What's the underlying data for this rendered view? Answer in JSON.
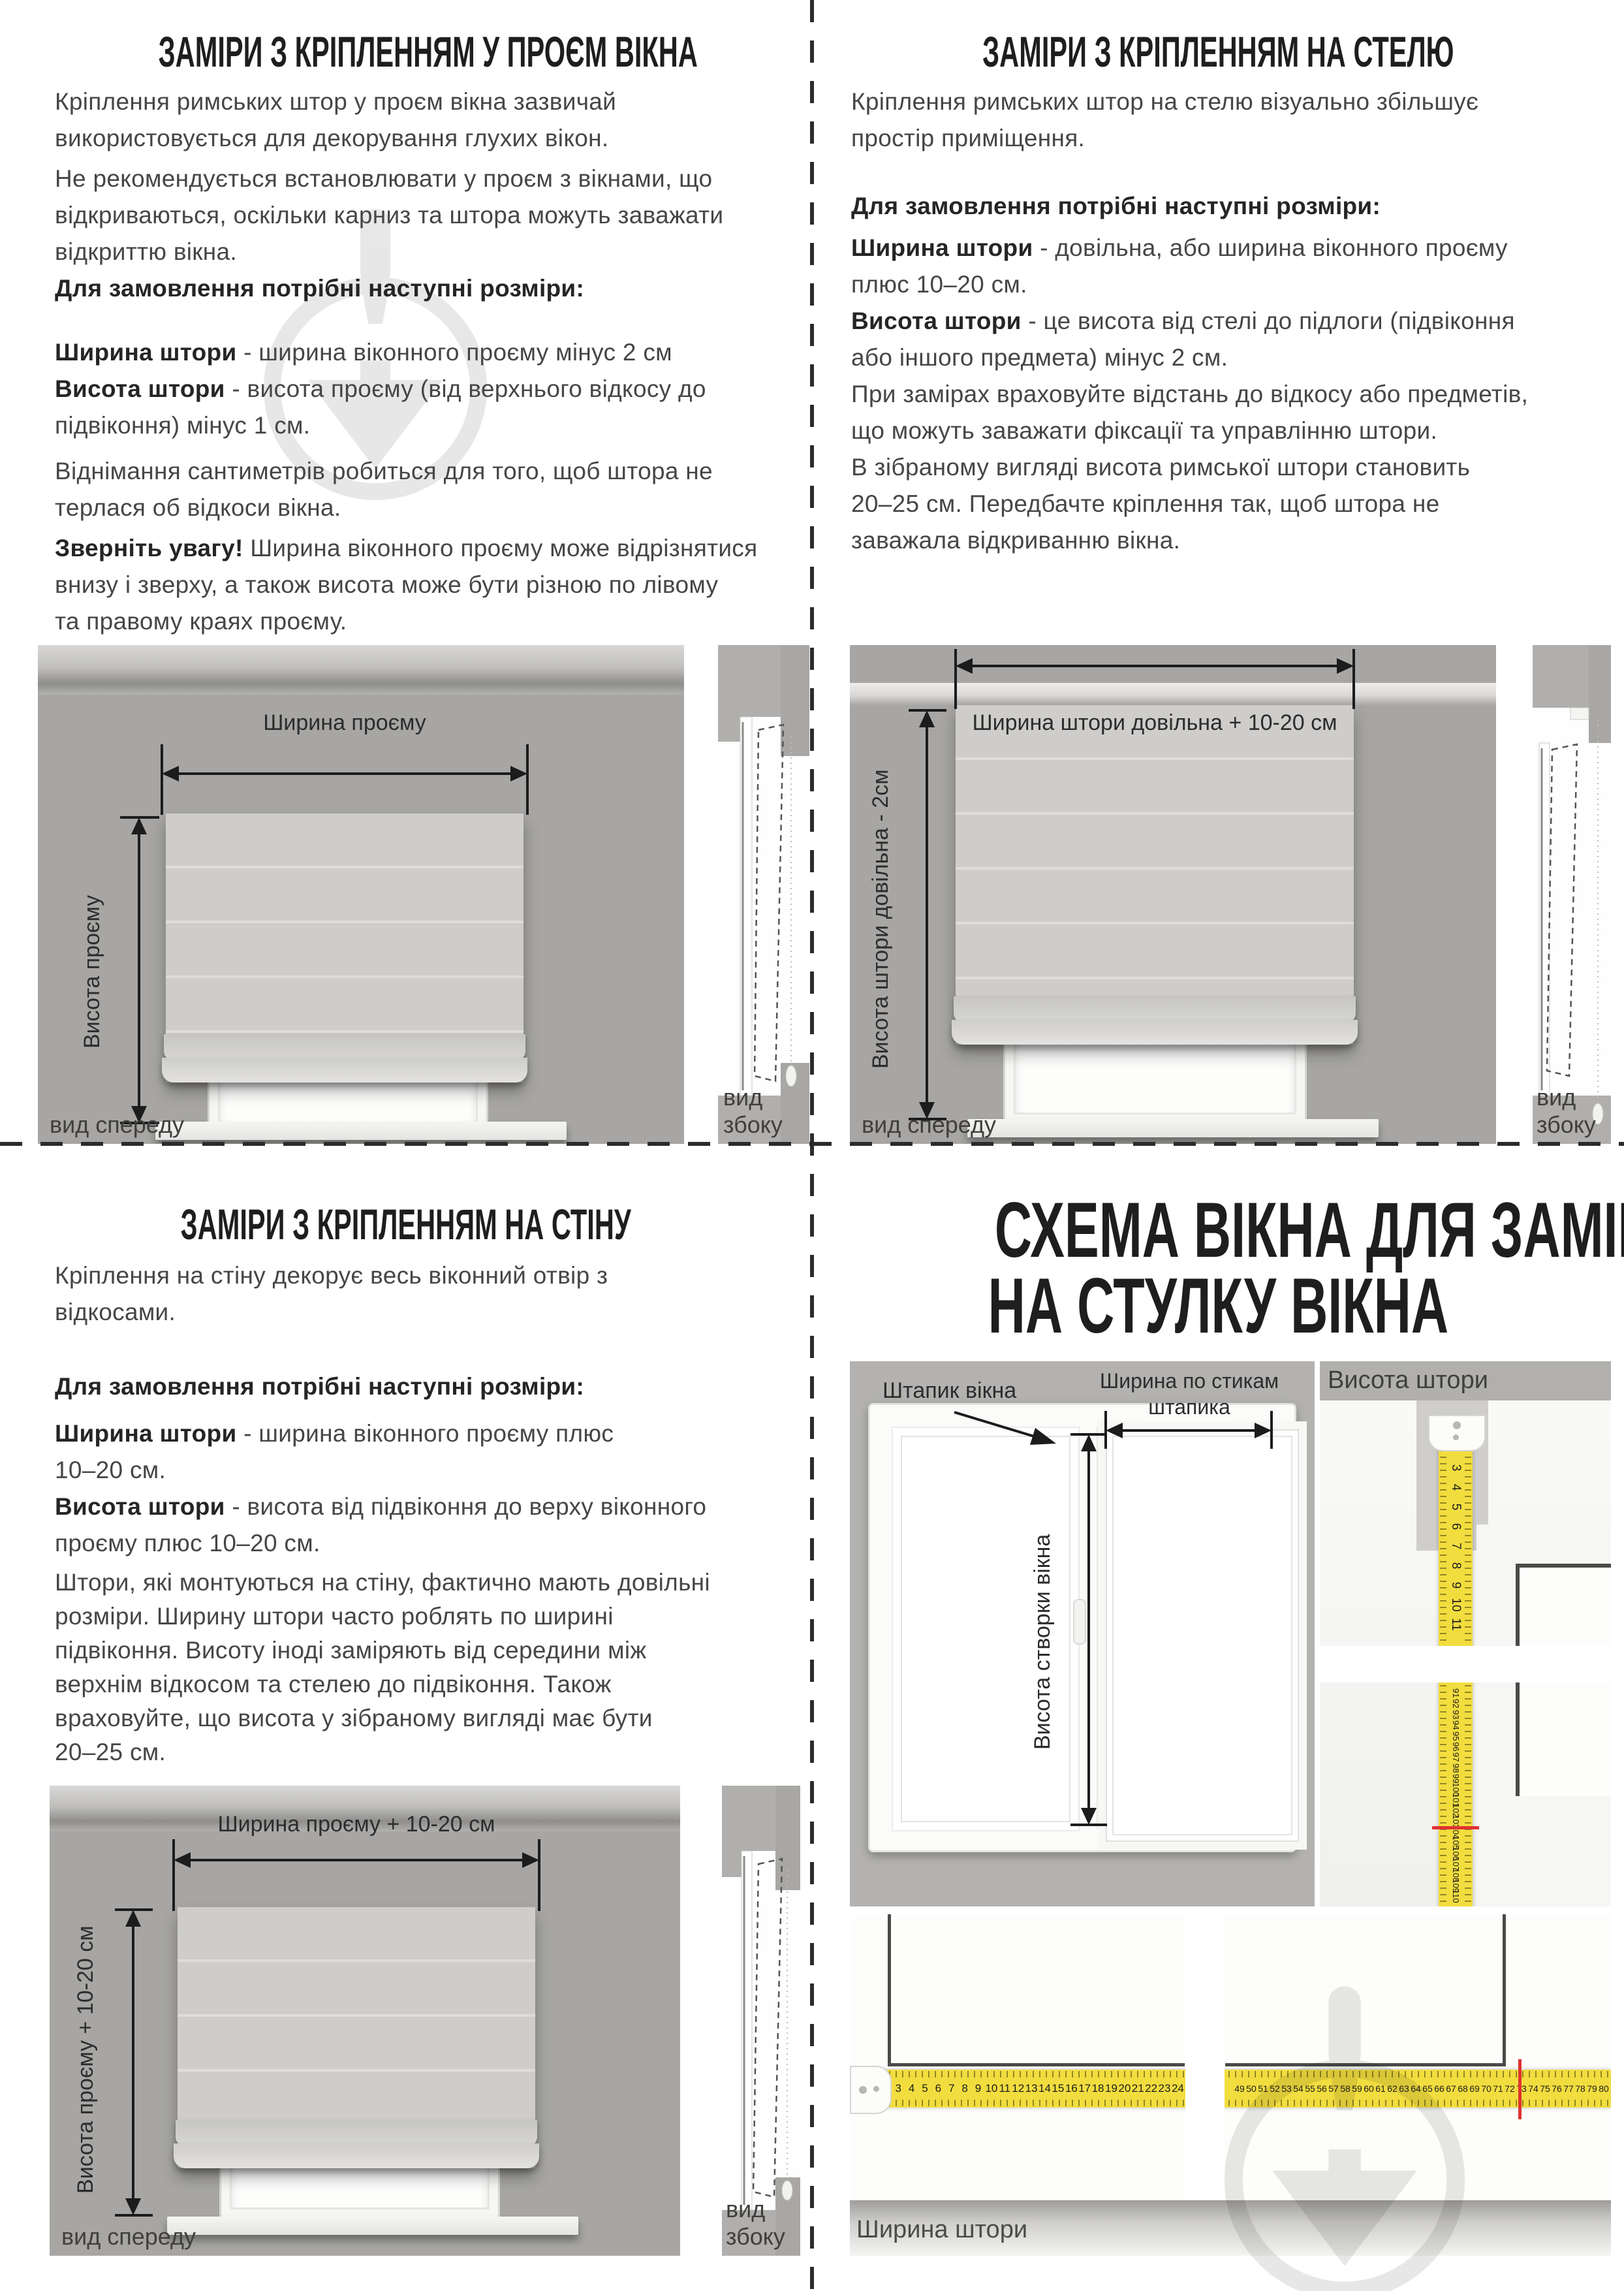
{
  "divider_color": "#2b2b2b",
  "opening": {
    "title": "ЗАМІРИ З КРІПЛЕННЯМ У ПРОЄМ ВІКНА",
    "p1": [
      "Кріплення римських штор у проєм вікна зазвичай",
      "використовується для декорування глухих вікон."
    ],
    "p2": [
      "Не рекомендується встановлювати у проєм з вікнами, що",
      "відкриваються, оскільки карниз та штора можуть заважати",
      "відкриттю вікна."
    ],
    "order_heading": "Для замовлення потрібні наступні розміри:",
    "sizes": [
      {
        "b": "Ширина штори",
        "t": " - ширина віконного проєму мінус 2 см"
      },
      {
        "b": "Висота штори",
        "t": " - висота проєму (від верхнього відкосу до"
      },
      {
        "t": "підвіконня) мінус 1 см."
      }
    ],
    "p3": [
      "Віднімання сантиметрів робиться для того, щоб штора не",
      "терлася об відкоси вікна."
    ],
    "note": [
      {
        "b": "Зверніть увагу!",
        "t": " Ширина віконного проєму може відрізнятися"
      },
      {
        "t": "внизу і зверху, а також висота може бути різною по лівому"
      },
      {
        "t": "та правому краях проєму."
      }
    ],
    "diagram": {
      "width_label": "Ширина проєму",
      "height_label": "Висота проєму",
      "front_view": "вид спереду",
      "side_view": "вид збоку"
    }
  },
  "ceiling": {
    "title": "ЗАМІРИ З КРІПЛЕННЯМ НА СТЕЛЮ",
    "p1": [
      "Кріплення римських штор на стелю візуально збільшує",
      "простір приміщення."
    ],
    "order_heading": "Для замовлення потрібні наступні розміри:",
    "sizes": [
      {
        "b": "Ширина штори",
        "t": " - довільна, або ширина віконного проєму"
      },
      {
        "t": "плюс 10–20 см."
      },
      {
        "b": "Висота штори",
        "t": " - це висота від стелі до підлоги (підвіконня"
      },
      {
        "t": "або іншого предмета) мінус 2 см."
      }
    ],
    "p2": [
      "При замірах враховуйте відстань до відкосу або предметів,",
      "що можуть заважати фіксації та управлінню штори.",
      "В зібраному вигляді висота римської штори становить",
      "20–25 см. Передбачте кріплення так, щоб штора не",
      "заважала відкриванню вікна."
    ],
    "diagram": {
      "width_label": "Ширина штори довільна + 10-20 см",
      "height_label": "Висота штори довільна - 2см",
      "front_view": "вид спереду",
      "side_view": "вид збоку"
    }
  },
  "wall": {
    "title": "ЗАМІРИ З КРІПЛЕННЯМ НА СТІНУ",
    "p1": [
      "Кріплення на стіну декорує весь віконний отвір з",
      "відкосами."
    ],
    "order_heading": "Для замовлення потрібні наступні розміри:",
    "sizes": [
      {
        "b": "Ширина штори",
        "t": " - ширина віконного проєму плюс"
      },
      {
        "t": "10–20 см."
      },
      {
        "b": "Висота штори",
        "t": " - висота від підвіконня до верху віконного"
      },
      {
        "t": "проєму плюс 10–20 см."
      }
    ],
    "p2": [
      "Штори, які монтуються на стіну, фактично мають довільні",
      "розміри. Ширину штори часто роблять по ширині",
      "підвіконня. Висоту іноді заміряють від середини між",
      "верхнім відкосом та стелею до підвіконня. Також",
      "враховуйте, що висота у зібраному вигляді має бути",
      "20–25 см."
    ],
    "diagram": {
      "width_label": "Ширина проєму + 10-20 см",
      "height_label": "Висота проєму + 10-20 см",
      "front_view": "вид спереду",
      "side_view": "вид збоку"
    }
  },
  "sash": {
    "title_line1": "СХЕМА ВІКНА ДЛЯ ЗАМІРІВ",
    "title_line2": "НА СТУЛКУ ВІКНА",
    "bead_label": "Штапик вікна",
    "bead_width_label_line1": "Ширина по стикам",
    "bead_width_label_line2": "штапика",
    "sash_height_label": "Висота створки вікна",
    "curtain_height_label": "Висота штори",
    "curtain_width_label": "Ширина штори",
    "tape": {
      "color": "#f2dd3f",
      "red_mark_color": "#e03232",
      "vertical_top_numbers": [
        3,
        4,
        5,
        6,
        7,
        8,
        9,
        10,
        11
      ],
      "vertical_bottom_numbers": [
        91,
        92,
        93,
        94,
        95,
        96,
        97,
        98,
        99,
        100,
        101,
        102,
        103,
        104,
        105,
        106,
        107,
        108,
        109,
        110
      ],
      "vertical_red_at": 104,
      "horizontal_left_numbers": [
        3,
        4,
        5,
        6,
        7,
        8,
        9,
        10,
        11,
        12,
        13,
        14,
        15,
        16,
        17,
        18,
        19,
        20,
        21,
        22,
        23,
        24
      ],
      "horizontal_right_numbers": [
        49,
        50,
        51,
        52,
        53,
        54,
        55,
        56,
        57,
        58,
        59,
        60,
        61,
        62,
        63,
        64,
        65,
        66,
        67,
        68,
        69,
        70,
        71,
        72,
        73,
        74,
        75,
        76,
        77,
        78,
        79,
        80
      ],
      "horizontal_red_at": 73
    }
  }
}
